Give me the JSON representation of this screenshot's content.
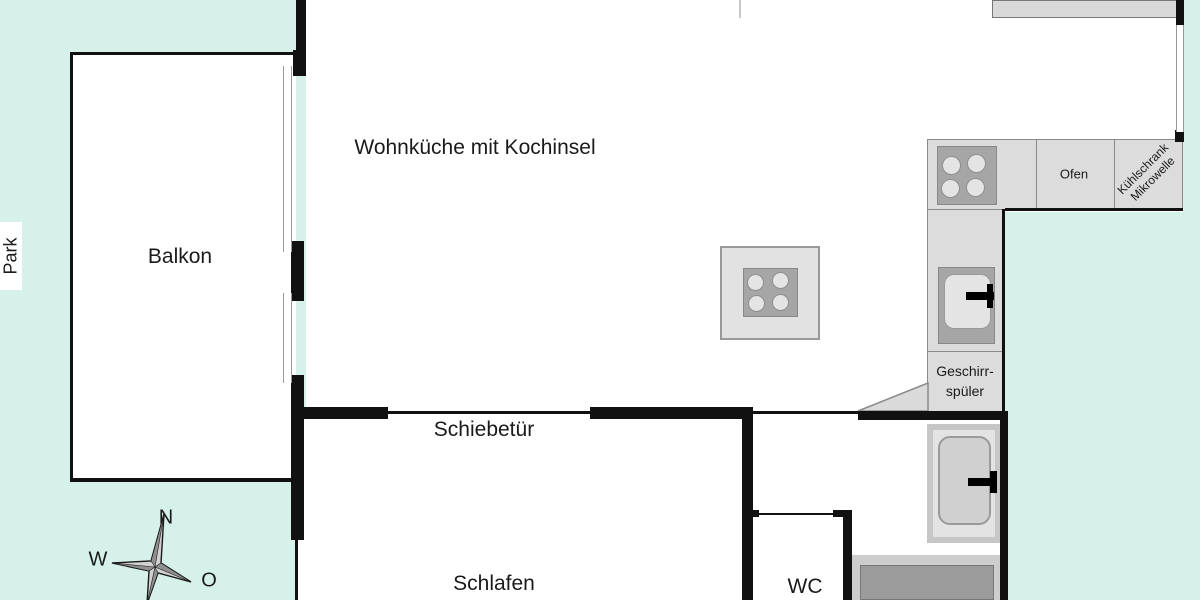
{
  "labels": {
    "park": "Park",
    "sliding_door": "Schiebetür",
    "oven": "Ofen",
    "fridge_line1": "Kühlschrank",
    "fridge_line2": "Mikrowelle",
    "dishwasher_line1": "Geschirr-",
    "dishwasher_line2": "spüler"
  },
  "rooms": {
    "living_kitchen": "Wohnküche mit Kochinsel",
    "balcony": "Balkon",
    "bedroom": "Schlafen",
    "wc": "WC"
  },
  "compass": {
    "north": "N",
    "west": "W",
    "east": "O"
  },
  "colors": {
    "outside": "#d5f1e9",
    "wall": "#111111",
    "interior": "#ffffff",
    "counter_fill": "#dcdcdc",
    "counter_border": "#8a8a8a",
    "fixture_dark": "#a6a6a6",
    "fixture_light": "#e4e4e4",
    "shower_dark": "#9b9b9b",
    "text": "#1a1a1a"
  }
}
